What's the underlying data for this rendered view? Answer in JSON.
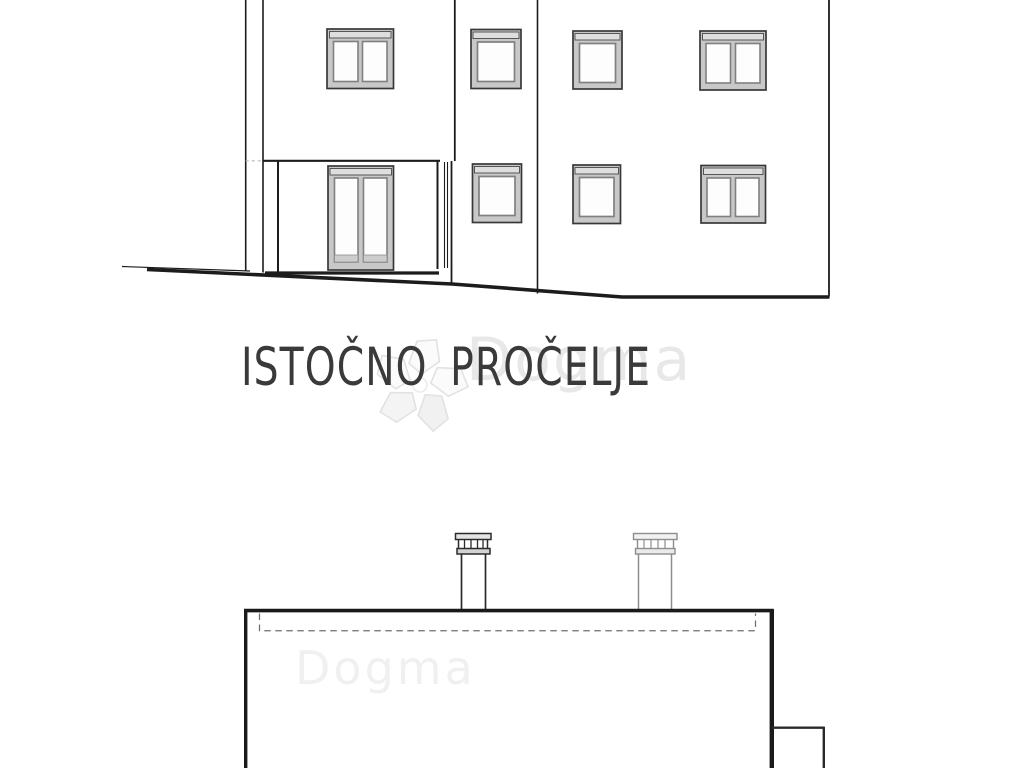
{
  "drawing": {
    "title": "ISTOČNO PROČELJE"
  },
  "watermark": {
    "text": "Dogma"
  },
  "colors": {
    "paper": "#ffffff",
    "ink": "#1c1c1c",
    "window_frame_fill": "#c8c8c8",
    "window_frame_edge": "#383838",
    "glass": "#fdfdfd",
    "shutter_bar": "#dedede",
    "chimney_secondary": "#8d8d8d",
    "watermark_gray": "#d6d6d6",
    "title_ink": "#3a3a3a"
  }
}
